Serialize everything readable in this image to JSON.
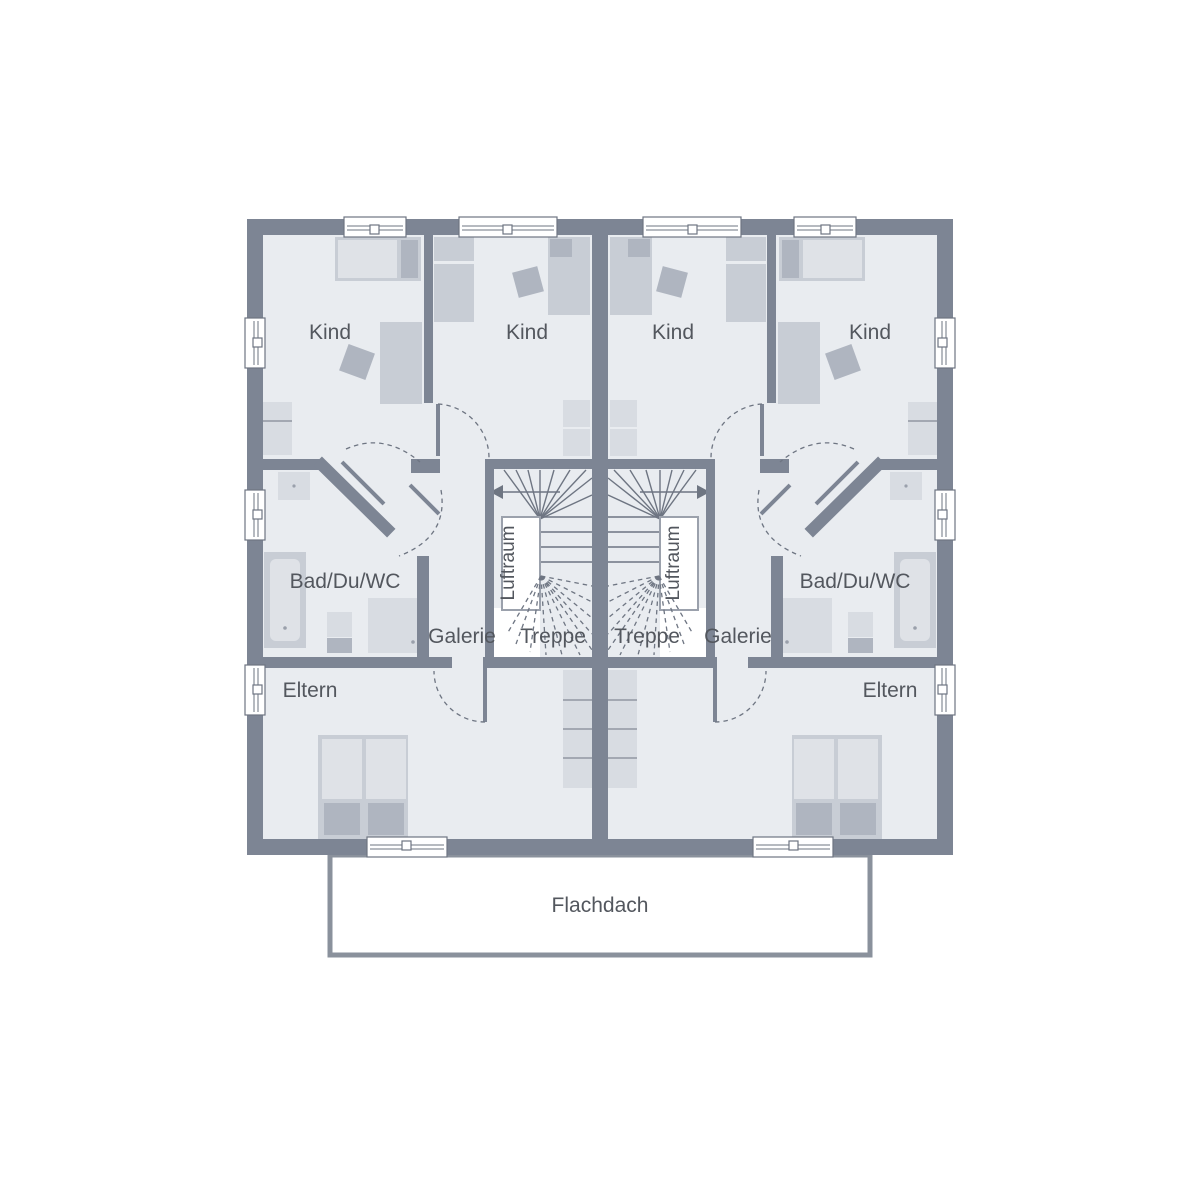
{
  "title": "Obergeschoss Grundriss Doppelhaus",
  "labels": {
    "kind": "Kind",
    "bath": "Bad/Du/WC",
    "gallery": "Galerie",
    "stairs": "Treppe",
    "airspace": "Luftraum",
    "parents": "Eltern",
    "flat_roof": "Flachdach"
  },
  "rooms": [
    {
      "unit": "left",
      "names": [
        "Kind",
        "Kind",
        "Bad/Du/WC",
        "Galerie",
        "Treppe",
        "Luftraum",
        "Eltern"
      ]
    },
    {
      "unit": "right",
      "names": [
        "Kind",
        "Kind",
        "Bad/Du/WC",
        "Galerie",
        "Treppe",
        "Luftraum",
        "Eltern"
      ]
    }
  ],
  "colors": {
    "wall": "#7d8594",
    "floor": "#e9ecf0",
    "line": "#6e7582",
    "text": "#53575e",
    "furn1": "#d8dce2",
    "furn2": "#c8cdd5",
    "furn3": "#afb5c0",
    "furn4": "#dfe2e7",
    "roofline": "#8a919c"
  }
}
